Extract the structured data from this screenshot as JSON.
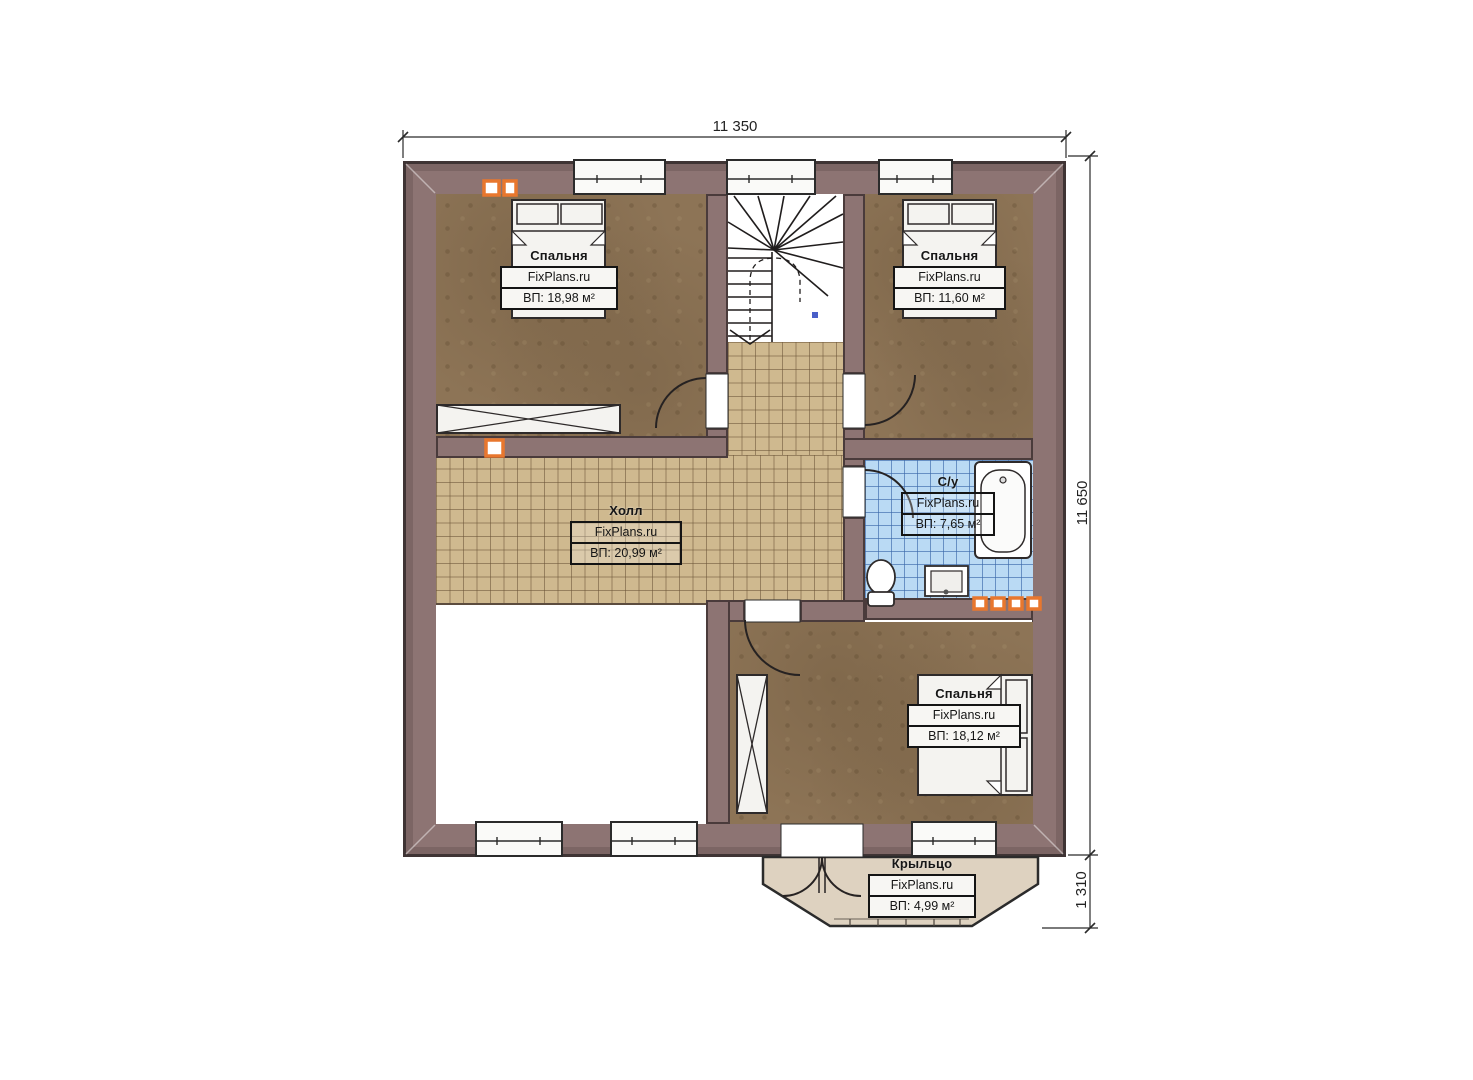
{
  "plan": {
    "brand": "FixPlans.ru",
    "dimensions": {
      "top": "11 350",
      "right": "11 650",
      "porch": "1 310"
    },
    "rooms": {
      "bedroom_top_left": {
        "title": "Спальня",
        "area": "ВП: 18,98 м²"
      },
      "bedroom_top_right": {
        "title": "Спальня",
        "area": "ВП: 11,60 м²"
      },
      "hall": {
        "title": "Холл",
        "area": "ВП: 20,99 м²"
      },
      "bathroom": {
        "title": "С/у",
        "area": "ВП: 7,65 м²"
      },
      "bedroom_bottom": {
        "title": "Спальня",
        "area": "ВП: 18,12 м²"
      },
      "porch": {
        "title": "Крыльцо",
        "area": "ВП: 4,99 м²"
      }
    },
    "colors": {
      "wall": "#8d7473",
      "wall_outline": "#3f3434",
      "bedroom_floor": "#8d7456",
      "hall_tile": "#cfb98f",
      "bath_tile": "#badaf4",
      "porch": "#ded2c0",
      "accent_orange": "#e8772e",
      "stair_marker_blue": "#4a5fc8"
    }
  }
}
